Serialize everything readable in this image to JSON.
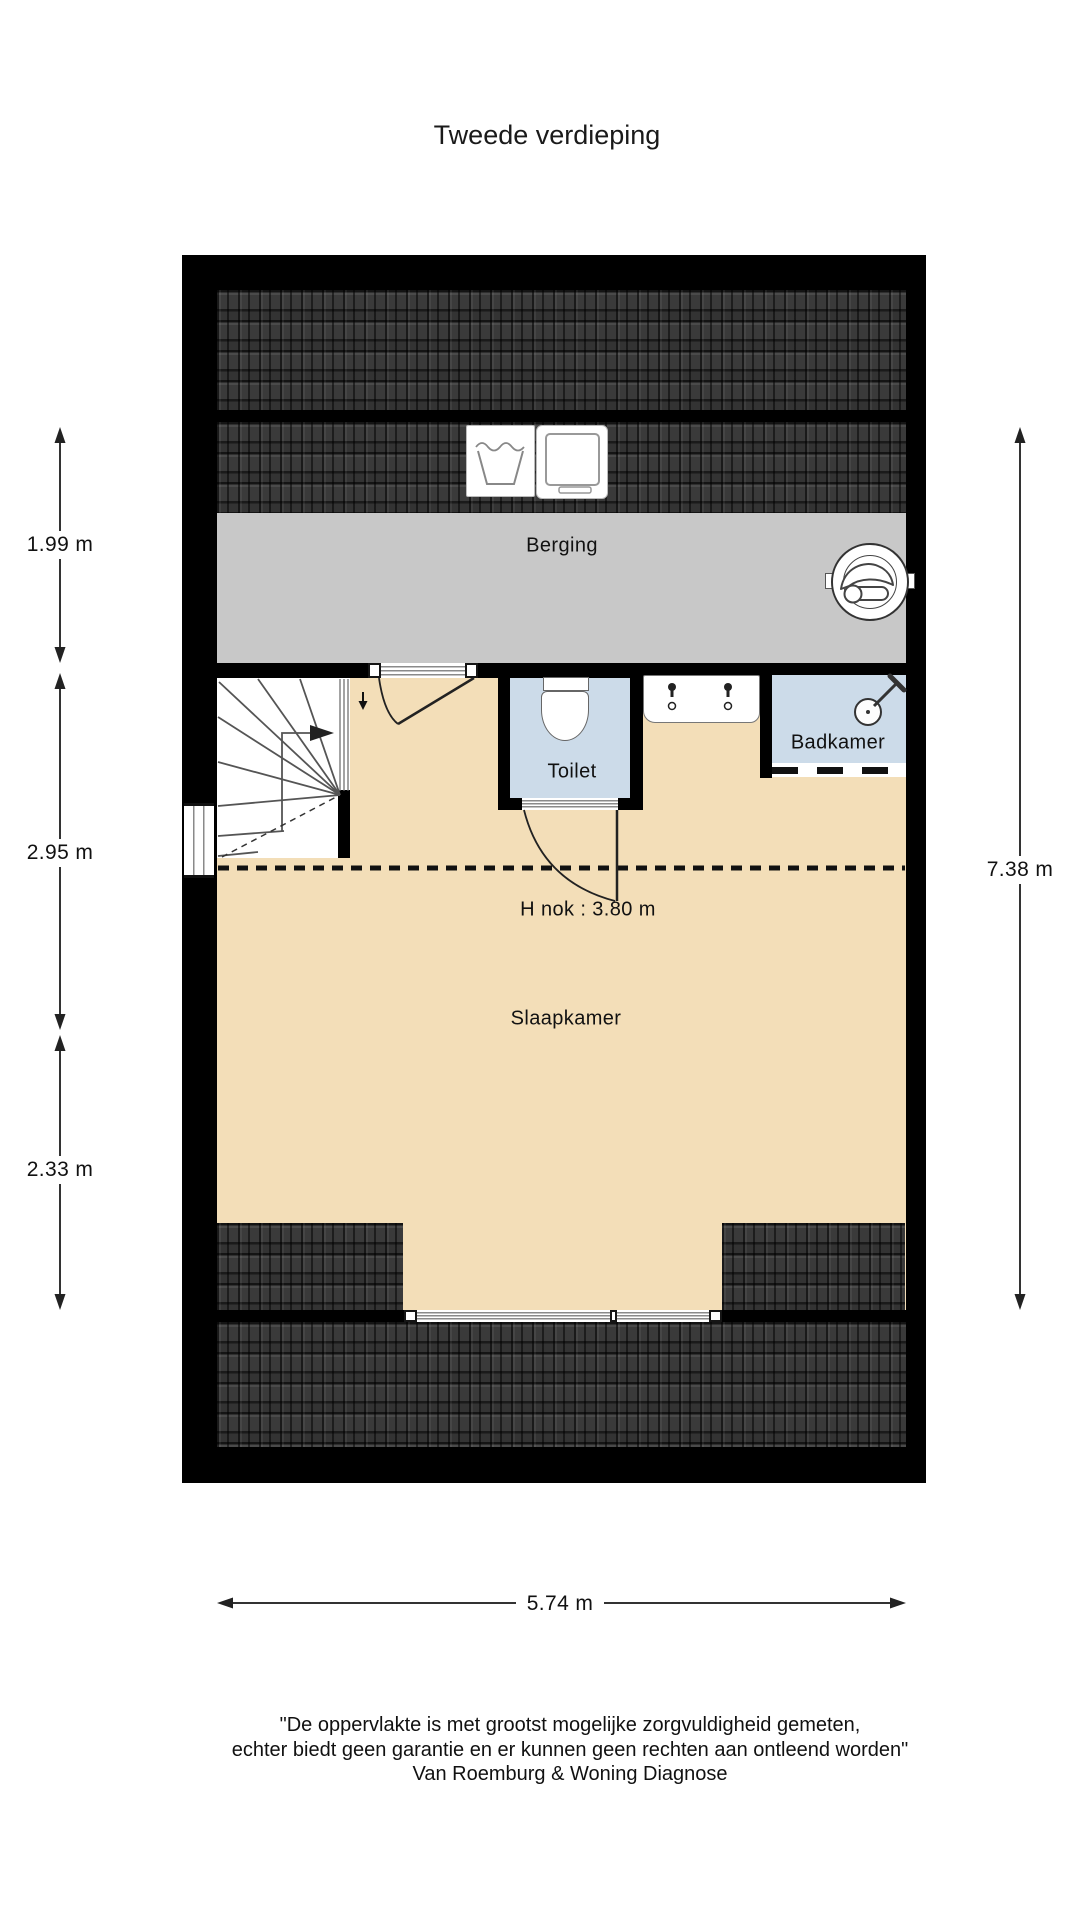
{
  "title": "Tweede verdieping",
  "rooms": {
    "berging": "Berging",
    "toilet": "Toilet",
    "badkamer": "Badkamer",
    "slaapkamer": "Slaapkamer"
  },
  "annotations": {
    "ridge_height": "H nok : 3.80 m"
  },
  "dimensions": {
    "left": [
      "1.99 m",
      "2.95 m",
      "2.33 m"
    ],
    "right": "7.38 m",
    "bottom": "5.74 m"
  },
  "icons": {
    "wash_symbol": "handwash-tub-icon",
    "washer": "washing-machine-icon",
    "vent": "mechanical-ventilation-unit-icon",
    "toilet": "toilet-fixture-icon",
    "sink": "double-sink-counter-icon",
    "shower": "shower-head-icon",
    "stairs": "winder-stairs-icon"
  },
  "footer": {
    "line1": "\"De oppervlakte is met grootst mogelijke zorgvuldigheid gemeten,",
    "line2": "echter biedt geen garantie en er kunnen geen rechten aan ontleend worden\"",
    "line3": "Van Roemburg & Woning Diagnose"
  },
  "colors": {
    "wall": "#000000",
    "floor_tan": "#f3deb8",
    "wet_room_blue": "#ccdbe9",
    "storage_gray": "#c8c8c8",
    "roof_dark": "#2f2f2f"
  }
}
